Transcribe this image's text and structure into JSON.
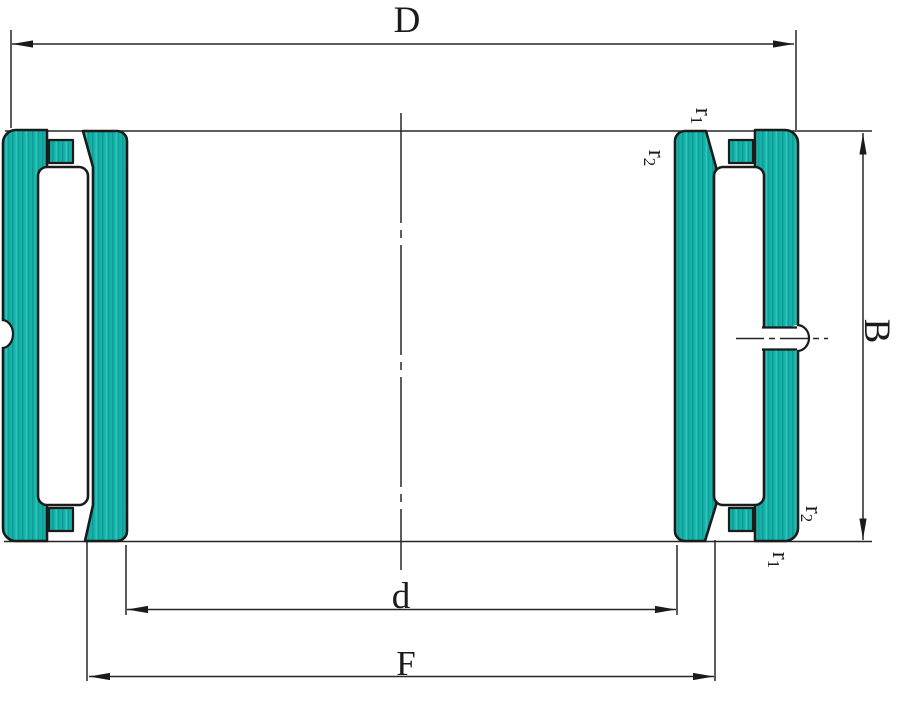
{
  "drawing": {
    "kind": "needle-roller-bearing-cross-section",
    "labels": {
      "outer_diameter": "D",
      "bore_diameter": "d",
      "raceway_diameter": "F",
      "width": "B",
      "r1_base": "r",
      "r1_sub": "1",
      "r2_base": "r",
      "r2_sub": "2"
    },
    "colors": {
      "ring_fill": "#14b2a9",
      "ring_streak_dark": "#0c9c94",
      "ring_streak_light": "#33cac1",
      "outline": "#1b1b1b",
      "thin_line": "#262626",
      "background": "#ffffff"
    }
  }
}
